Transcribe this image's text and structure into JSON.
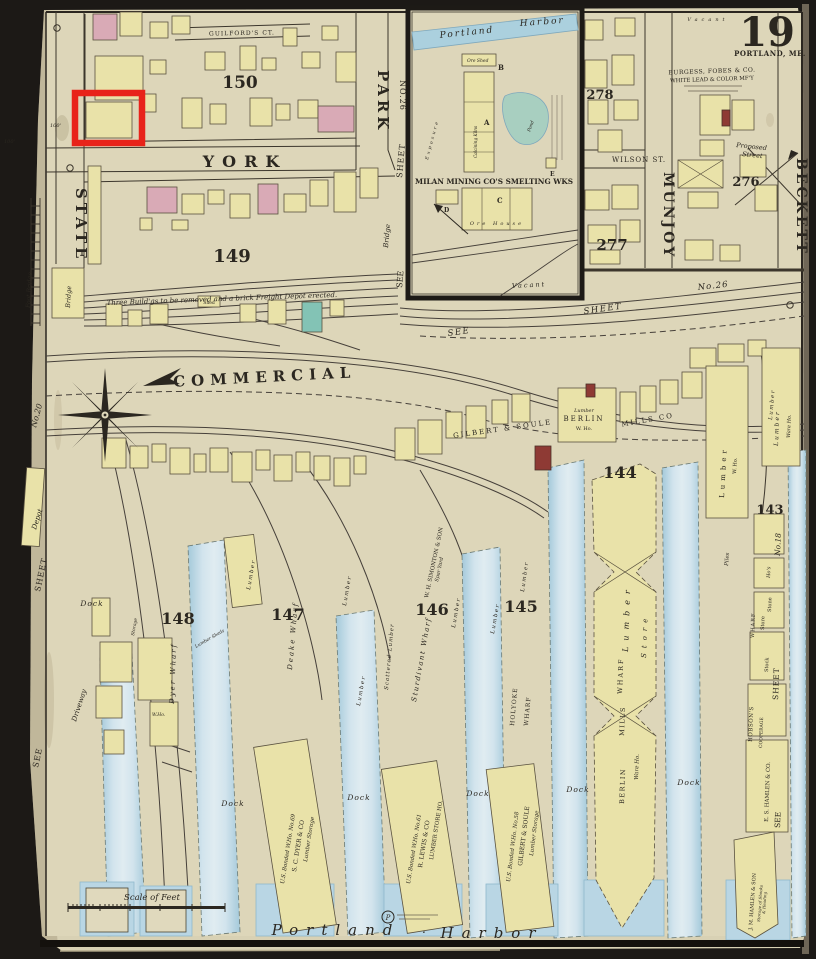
{
  "page": {
    "sheet_number": "19",
    "city": "PORTLAND, ME.",
    "scale_label": "Scale of Feet",
    "harbor_word1": "Portland",
    "harbor_dot": ".",
    "harbor_word2": "Harbor",
    "stamp_letter": "P",
    "dim_100a": "100'",
    "dim_100b": "100'"
  },
  "streets": {
    "york": "YORK",
    "state": "STATE",
    "park": "PARK",
    "commercial": "COMMERCIAL",
    "munjoy": "MUNJOY",
    "beckett": "BECKETT",
    "wilson": "WILSON ST.",
    "guilfords_ct": "GUILFORD'S CT.",
    "proposed_line1": "Proposed",
    "proposed_line2": "Street"
  },
  "blocks": {
    "n150": "150",
    "n149": "149",
    "n148": "148",
    "n147": "147",
    "n146": "146",
    "n145": "145",
    "n144": "144",
    "n143": "143",
    "n278": "278",
    "n277": "277",
    "n276": "276"
  },
  "margins": {
    "no20": "No.20",
    "sheet_left": "SHEET",
    "see_left": "SEE",
    "sheet_park": "SHEET",
    "no26_park": "NO.26",
    "sheet_inset": "SHEET",
    "see_inset": "SEE",
    "bridge_inset": "Bridge",
    "see_diag": "SEE",
    "sheet_diag": "SHEET",
    "no26_diag": "No.26",
    "sheet_right": "SHEET",
    "no18": "No.18",
    "see_right": "SEE",
    "foot_bridge": "Foot Bridge",
    "bridge": "Bridge",
    "depot": "Depot",
    "driveway": "Driveway"
  },
  "inset": {
    "portland": "Portland",
    "harbor": "Harbor",
    "title": "MILAN MINING CO'S SMELTING WKS",
    "ore_shed": "Ore Shed",
    "key_a": "A",
    "key_b": "B",
    "key_c": "C",
    "key_d": "D",
    "key_e": "E",
    "calcining": "Calcining Kilns",
    "pond": "Pond",
    "ore_house": "Ore House",
    "vacant": "Vacant",
    "exposure": "Exposure"
  },
  "upland": {
    "burgess_line1": "BURGESS, FOBES & CO.",
    "burgess_line2": "WHITE LEAD & COLOR MF'Y",
    "vacant_top": "Vacant",
    "note_149": "Three Build'gs to be removed and a brick Freight Depot erected.",
    "shed": "Shed",
    "gilbert_soule": "GILBERT & SOULE",
    "berlin_lumber": "Lumber",
    "berlin": "BERLIN",
    "berlin_who": "W. Ho.",
    "mills_co": "MILLS CO"
  },
  "wharves": {
    "dyer": "Dyer Wharf",
    "deake": "Deake Wharf",
    "scattered": "Scattered Lumber",
    "sturdivant": "Sturdivant Wharf",
    "holyoke1": "HOLYOKE",
    "holyoke2": "WHARF",
    "simonton": "W. H. SIMONTON & SON",
    "spar_yard": "Spar Yard",
    "lumber": "Lumber",
    "piles": "Piles",
    "dock": "Dock",
    "lumber_w_ho1": "Lumber",
    "lumber_w_ho2": "W. Ho.",
    "ware_right1": "Lumber",
    "ware_right2": "Ware Ho.",
    "bm_lumber": "Lumber",
    "bm_store": "Store",
    "bm_wharf": "WHARF",
    "bm_mills": "MILLS",
    "bm_berlin": "BERLIN",
    "bm_ware": "Ware Ho.",
    "bonded1_line1": "U.S. Bonded W.Ho. No.69",
    "bonded1_line2": "S. C. DYER & CO",
    "bonded1_line3": "Lumber Storage",
    "bonded2_line1": "U.S. Bonded W.Ho. No.61",
    "bonded2_line2": "R. LEWIS & CO",
    "bonded2_line3": "LUMBER STORE HO.",
    "bonded3_line1": "U.S. Bonded W.Ho. No.58",
    "bonded3_line2": "GILBERT & SOULE",
    "bonded3_line3": "Lumber Storage",
    "storage": "Storage",
    "lumber_sheds": "Lumber Sheds",
    "w_ho": "W.Ho.",
    "hos": "Ho's",
    "stone": "Stone",
    "stock": "Stock",
    "store": "Store",
    "wharf": "WHARF",
    "hobsons": "HOBSON'S",
    "cooperage": "COOPERAGE",
    "es_hamlen": "E. S. HAMLEN & CO.",
    "jm_hamlen": "J. M. HAMLEN & SON",
    "shooks1": "Storage of Shooks",
    "shooks2": "& Heading"
  }
}
